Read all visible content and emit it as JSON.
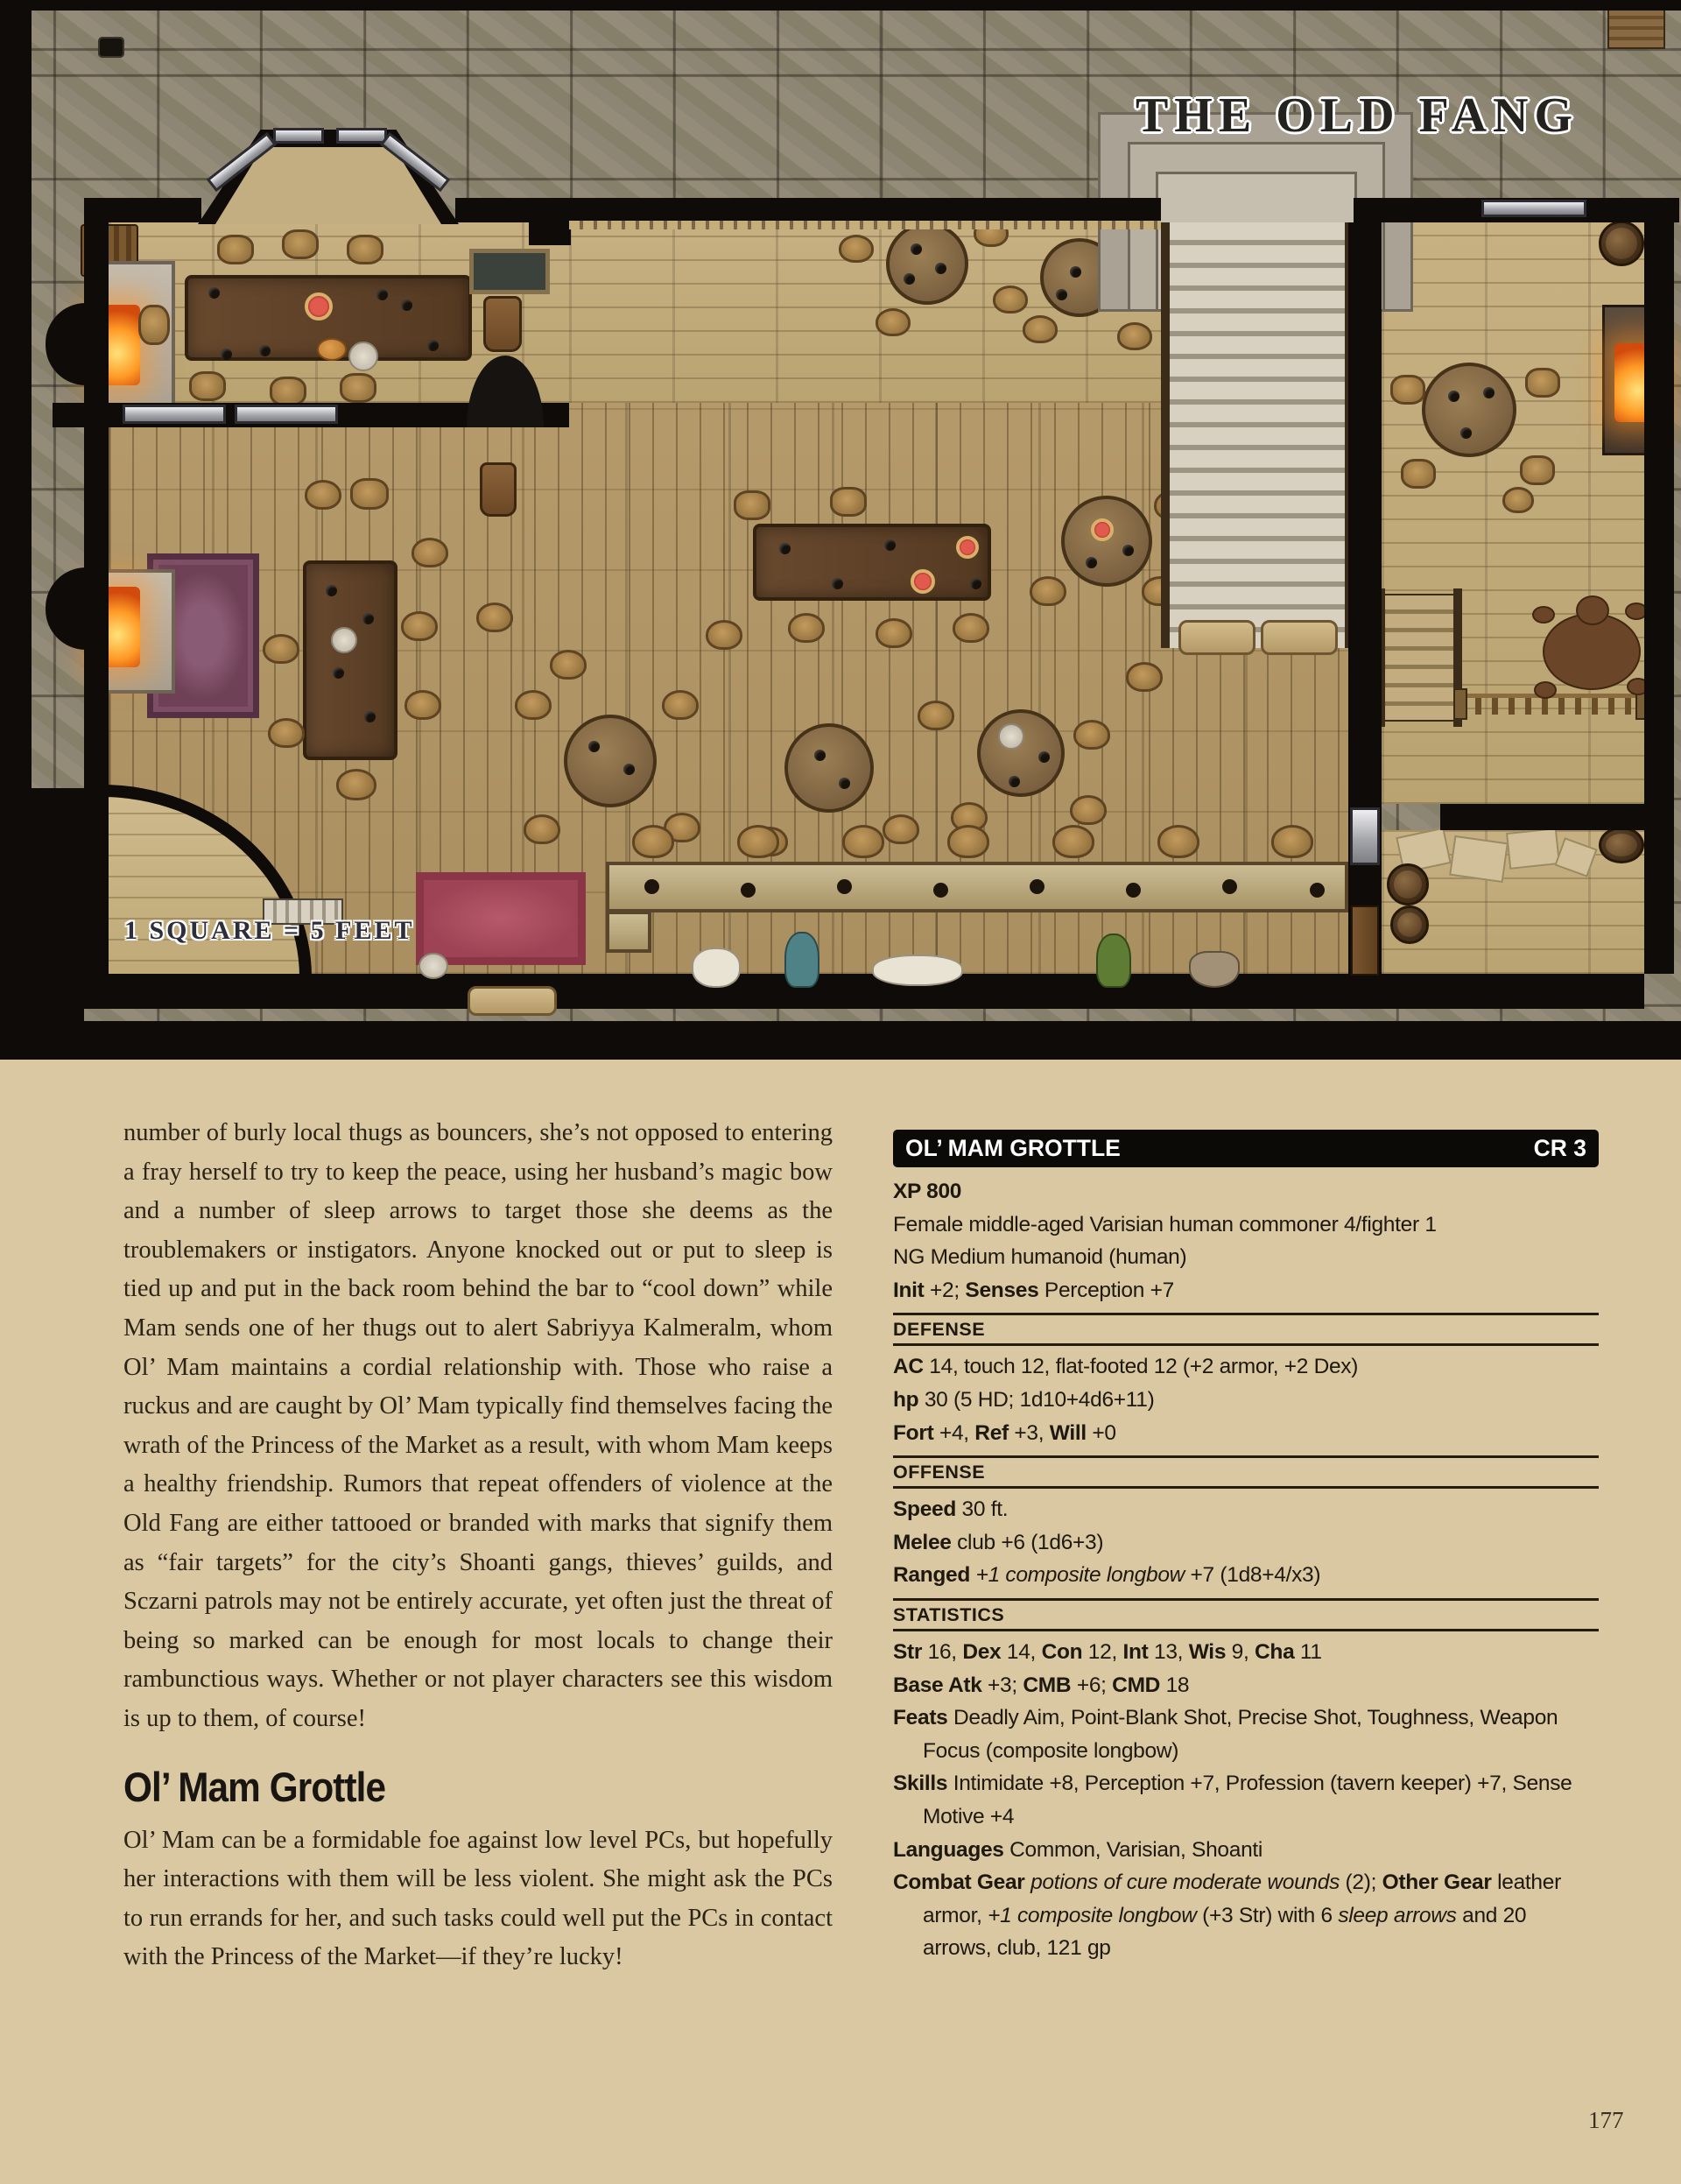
{
  "map": {
    "title": "THE OLD FANG",
    "scale_label": "1 SQUARE = 5 FEET"
  },
  "left_column": {
    "paragraph1": "number of burly local thugs as bouncers, she’s not opposed to entering a fray herself to try to keep the peace, using her husband’s magic bow and a number of sleep arrows to target those she deems as the troublemakers or instigators. Anyone knocked out or put to sleep is tied up and put in the back room behind the bar to “cool down” while Mam sends one of her thugs out to alert Sabriyya Kalmeralm, whom Ol’ Mam maintains a cordial relationship with. Those who raise a ruckus and are caught by Ol’ Mam typically find themselves facing the wrath of the Princess of the Market as a result, with whom Mam keeps a healthy friendship. Rumors that repeat offenders of violence at the Old Fang are either tattooed or branded with marks that signify them as “fair targets” for the city’s Shoanti gangs, thieves’ guilds, and Sczarni patrols may not be entirely accurate, yet often just the threat of being so marked can be enough for most locals to change their rambunctious ways. Whether or not player characters see this wisdom is up to them, of course!",
    "heading": "Ol’ Mam Grottle",
    "paragraph2": "Ol’ Mam can be a formidable foe against low level PCs, but hopefully her interactions with them will be less violent. She might ask the PCs to run errands for her, and such tasks could well put the PCs in contact with the Princess of the Market—if they’re lucky!"
  },
  "stat_block": {
    "title": "OL’ MAM GROTTLE",
    "cr": "CR 3",
    "intro": [
      [
        {
          "b": "XP 800"
        }
      ],
      [
        {
          "t": "Female middle-aged Varisian human commoner 4/fighter 1"
        }
      ],
      [
        {
          "t": "NG Medium humanoid (human)"
        }
      ],
      [
        {
          "b": "Init"
        },
        {
          "t": " +2; "
        },
        {
          "b": "Senses"
        },
        {
          "t": " Perception +7"
        }
      ]
    ],
    "sections": [
      {
        "label": "DEFENSE",
        "lines": [
          [
            {
              "b": "AC"
            },
            {
              "t": " 14, touch 12, flat-footed 12 (+2 armor, +2 Dex)"
            }
          ],
          [
            {
              "b": "hp"
            },
            {
              "t": " 30 (5 HD; 1d10+4d6+11)"
            }
          ],
          [
            {
              "b": "Fort"
            },
            {
              "t": " +4, "
            },
            {
              "b": "Ref"
            },
            {
              "t": " +3, "
            },
            {
              "b": "Will"
            },
            {
              "t": " +0"
            }
          ]
        ]
      },
      {
        "label": "OFFENSE",
        "lines": [
          [
            {
              "b": "Speed"
            },
            {
              "t": " 30 ft."
            }
          ],
          [
            {
              "b": "Melee"
            },
            {
              "t": " club +6 (1d6+3)"
            }
          ],
          [
            {
              "b": "Ranged"
            },
            {
              "t": " "
            },
            {
              "i": "+1 composite longbow"
            },
            {
              "t": " +7 (1d8+4/x3)"
            }
          ]
        ]
      },
      {
        "label": "STATISTICS",
        "lines": [
          [
            {
              "b": "Str"
            },
            {
              "t": " 16, "
            },
            {
              "b": "Dex"
            },
            {
              "t": " 14, "
            },
            {
              "b": "Con"
            },
            {
              "t": " 12, "
            },
            {
              "b": "Int"
            },
            {
              "t": " 13, "
            },
            {
              "b": "Wis"
            },
            {
              "t": " 9, "
            },
            {
              "b": "Cha"
            },
            {
              "t": " 11"
            }
          ],
          [
            {
              "b": "Base Atk"
            },
            {
              "t": " +3; "
            },
            {
              "b": "CMB"
            },
            {
              "t": " +6; "
            },
            {
              "b": "CMD"
            },
            {
              "t": " 18"
            }
          ],
          [
            {
              "b": "Feats"
            },
            {
              "t": " Deadly Aim, Point-Blank Shot, Precise Shot, Toughness, Weapon Focus (composite longbow)"
            }
          ],
          [
            {
              "b": "Skills"
            },
            {
              "t": " Intimidate +8, Perception +7, Profession (tavern keeper) +7, Sense Motive +4"
            }
          ],
          [
            {
              "b": "Languages"
            },
            {
              "t": " Common, Varisian, Shoanti"
            }
          ],
          [
            {
              "b": "Combat Gear"
            },
            {
              "t": " "
            },
            {
              "i": "potions of cure moderate wounds"
            },
            {
              "t": " (2); "
            },
            {
              "b": "Other Gear"
            },
            {
              "t": " leather armor, "
            },
            {
              "i": "+1 composite longbow"
            },
            {
              "t": " (+3 Str) with 6 "
            },
            {
              "i": "sleep arrows"
            },
            {
              "t": " and 20 arrows, club, 121 gp"
            }
          ]
        ]
      }
    ]
  },
  "page_number": "177",
  "colors": {
    "page_background": "#d9c8a2",
    "stat_bar": "#0c0a07",
    "stone": "#8e8675",
    "wood_floor": "#b49a6b",
    "fire": "#ff9a26",
    "rug_red": "#9e4355",
    "rug_purple": "#6f4156"
  }
}
